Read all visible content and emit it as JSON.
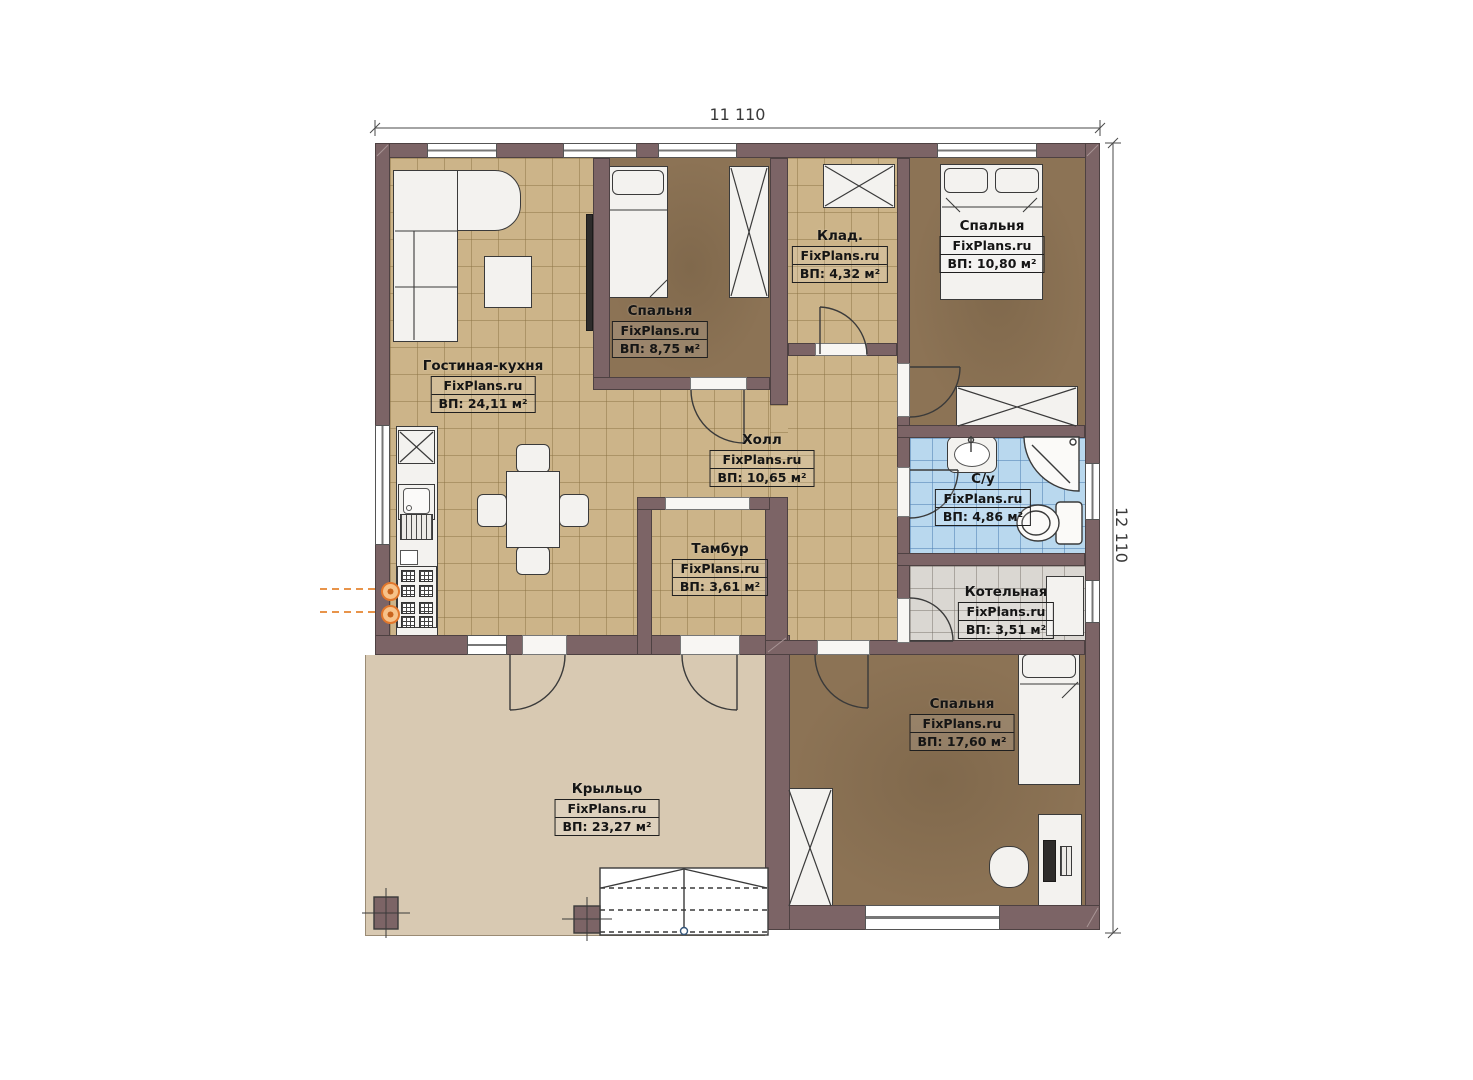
{
  "title": "Floor plan",
  "dimensions": {
    "width_label": "11 110",
    "height_label": "12 110"
  },
  "rooms": [
    {
      "id": "living-kitchen",
      "name": "Гостиная-кухня",
      "brand": "FixPlans.ru",
      "area": "ВП: 24,11 м²"
    },
    {
      "id": "bedroom-1",
      "name": "Спальня",
      "brand": "FixPlans.ru",
      "area": "ВП: 8,75 м²"
    },
    {
      "id": "storage",
      "name": "Клад.",
      "brand": "FixPlans.ru",
      "area": "ВП: 4,32 м²"
    },
    {
      "id": "bedroom-2",
      "name": "Спальня",
      "brand": "FixPlans.ru",
      "area": "ВП: 10,80 м²"
    },
    {
      "id": "hall",
      "name": "Холл",
      "brand": "FixPlans.ru",
      "area": "ВП: 10,65 м²"
    },
    {
      "id": "bathroom",
      "name": "С/у",
      "brand": "FixPlans.ru",
      "area": "ВП: 4,86 м²"
    },
    {
      "id": "tambour",
      "name": "Тамбур",
      "brand": "FixPlans.ru",
      "area": "ВП: 3,61 м²"
    },
    {
      "id": "boiler-room",
      "name": "Котельная",
      "brand": "FixPlans.ru",
      "area": "ВП: 3,51 м²"
    },
    {
      "id": "bedroom-3",
      "name": "Спальня",
      "brand": "FixPlans.ru",
      "area": "ВП: 17,60 м²"
    },
    {
      "id": "porch",
      "name": "Крыльцо",
      "brand": "FixPlans.ru",
      "area": "ВП: 23,27 м²"
    }
  ],
  "colors": {
    "wall": "#7c6466",
    "floor_tile_tan": "#ccb489",
    "floor_bedroom_brown": "#8c7355",
    "floor_bathroom_blue": "#b9d8ee",
    "floor_boiler_gray": "#dad7d2",
    "porch_beige": "#d8c9b2",
    "gas_accent_orange": "#e2772b"
  }
}
